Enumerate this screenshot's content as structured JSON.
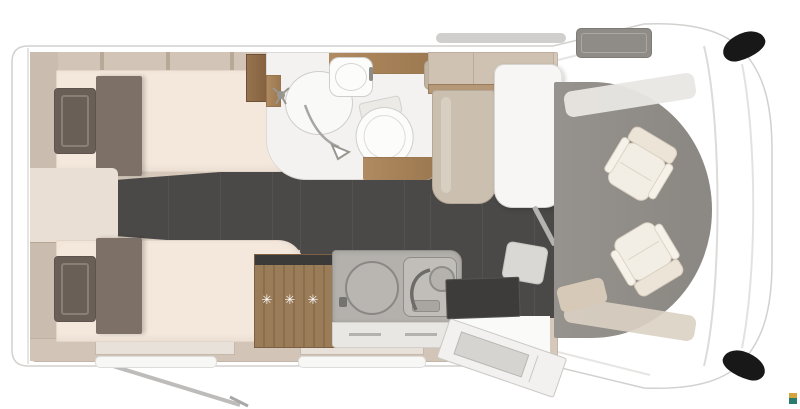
{
  "diagram": {
    "type": "motorhome-floor-plan-top-view",
    "freezer_rating": "✳ ✳ ✳",
    "areas": [
      "twin-bed-top",
      "twin-bed-bottom",
      "bathroom",
      "shower",
      "washbasin",
      "toilet",
      "kitchen",
      "fridge-freezer",
      "sink",
      "stove",
      "dinette-bench",
      "table",
      "entrance-door",
      "cab-seat-driver",
      "cab-seat-passenger"
    ]
  },
  "palette": {
    "wall": "#d6c9bc",
    "wall-dark": "#cabdaf",
    "wood": "#b08a60",
    "wood-dark": "#8a6746",
    "floor-dark": "#4b4947",
    "cab-floor": "#96928d",
    "mattress": "#f4e8dc",
    "runner": "#7d7066",
    "pillow": "#6a5f57",
    "seat-cream": "#f3eee5",
    "bench-tan": "#cbbfaf",
    "counter-gray": "#b4b1ac",
    "mat-dark": "#3e3c3a",
    "mirror-black": "#181818",
    "logo-gold": "#d2a63d",
    "logo-teal": "#2a7a6e"
  }
}
